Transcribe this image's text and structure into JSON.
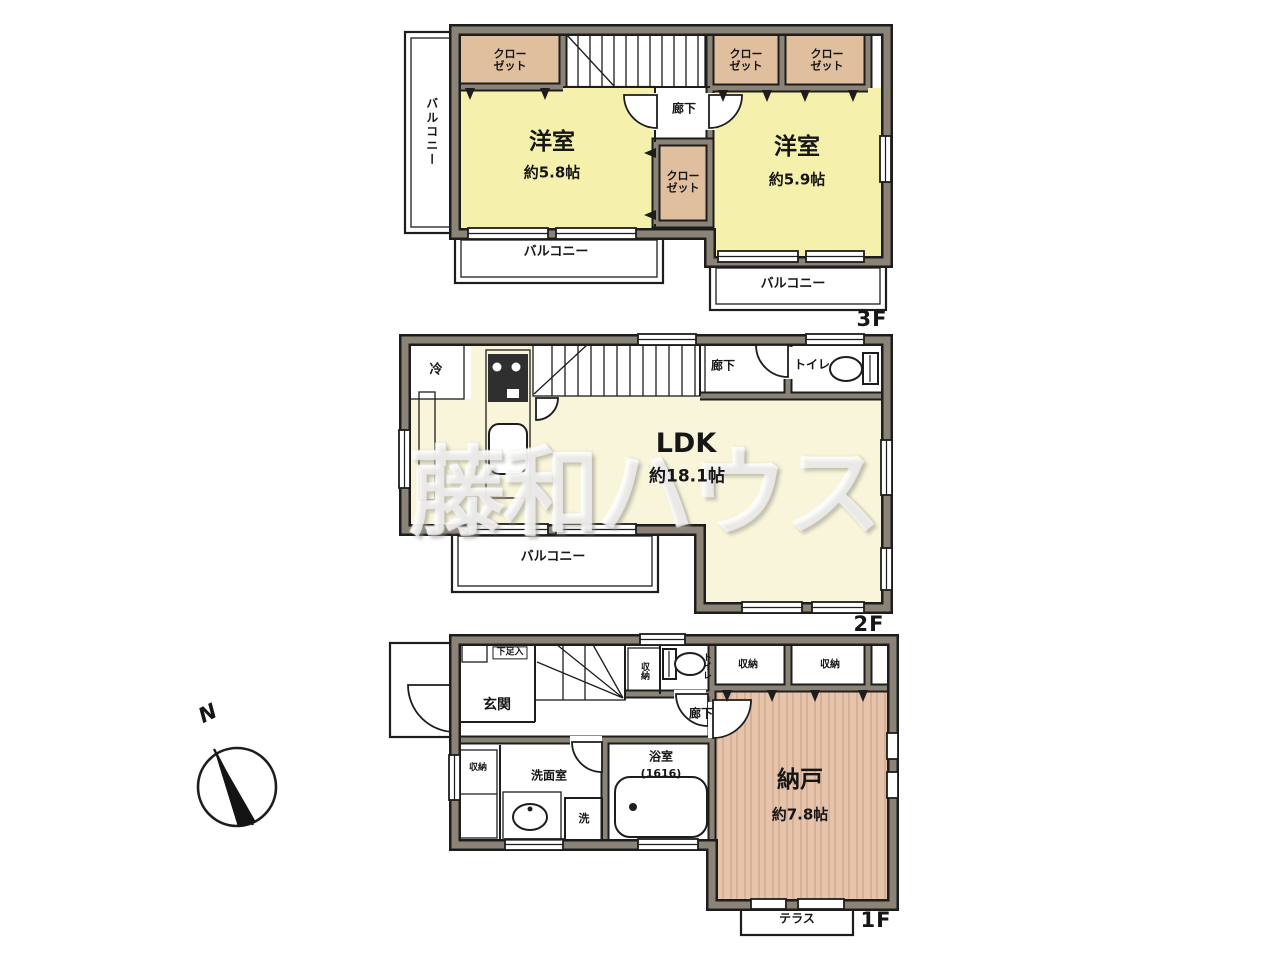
{
  "watermark": "藤和ハウス",
  "labels": {
    "closet": "クロー\nゼット",
    "balcony": "バルコニー",
    "hallway": "廊下",
    "toilet": "トイレ",
    "storage": "収納"
  },
  "floor3": {
    "label": "3F",
    "room_left": {
      "name": "洋室",
      "size": "約5.8帖"
    },
    "room_right": {
      "name": "洋室",
      "size": "約5.9帖"
    }
  },
  "floor2": {
    "label": "2F",
    "ldk": {
      "name": "LDK",
      "size": "約18.1帖"
    },
    "fridge": "冷"
  },
  "floor1": {
    "label": "1F",
    "entrance": "玄関",
    "shoe_box": "下足入",
    "storeroom": {
      "name": "納戸",
      "size": "約7.8帖"
    },
    "washroom": "洗面室",
    "washer": "洗",
    "bath": {
      "name": "浴室",
      "size": "(1616)"
    },
    "terrace": "テラス"
  },
  "compass": {
    "north": "N"
  },
  "colors": {
    "wall": "#8a8376",
    "line": "#1d1d1d",
    "room_yellow": "#f5f1ac",
    "ldk_cream": "#f9f5da",
    "closet_tan": "#dfbf9e",
    "storeroom_pink": "#e6c4ab",
    "cabinet_pink": "#ecd0b8"
  }
}
